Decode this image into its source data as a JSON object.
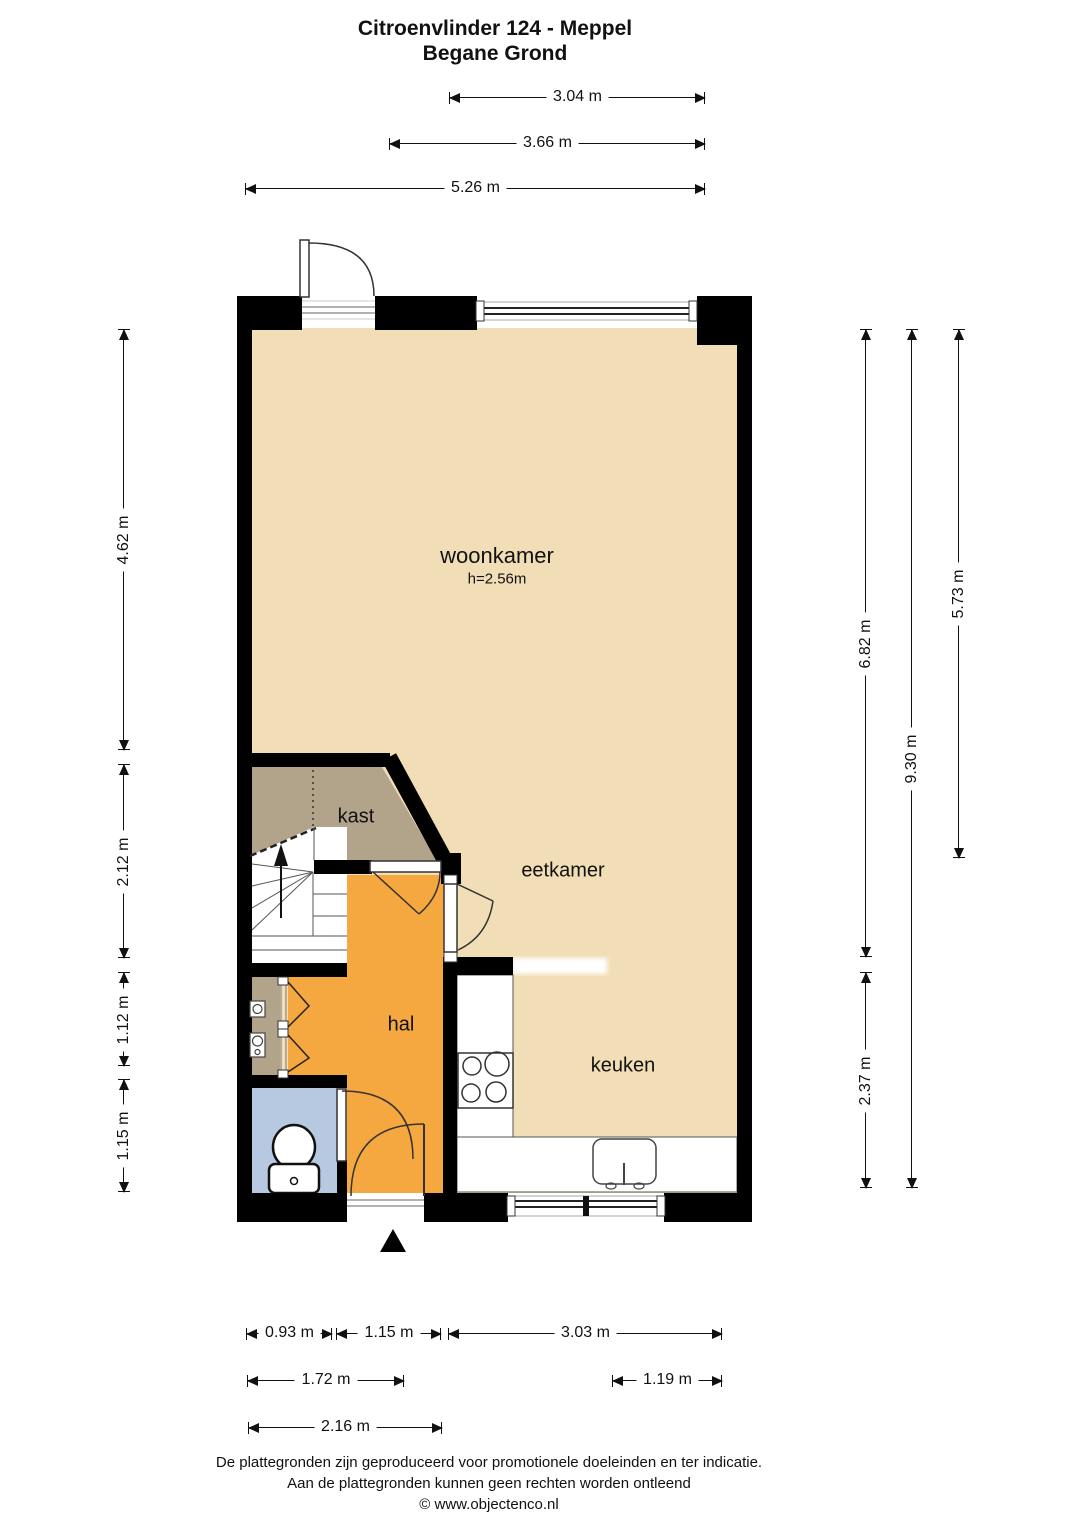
{
  "title": {
    "line1": "Citroenvlinder 124 - Meppel",
    "line2": "Begane Grond"
  },
  "rooms": {
    "woonkamer": {
      "label": "woonkamer",
      "height_note": "h=2.56m"
    },
    "kast": {
      "label": "kast"
    },
    "eetkamer": {
      "label": "eetkamer"
    },
    "hal": {
      "label": "hal"
    },
    "keuken": {
      "label": "keuken"
    }
  },
  "dimensions": {
    "top": [
      "3.04 m",
      "3.66 m",
      "5.26 m"
    ],
    "left": [
      "4.62 m",
      "2.12 m",
      "1.12 m",
      "1.15 m"
    ],
    "right": [
      "6.82 m",
      "9.30 m",
      "5.73 m",
      "2.37 m"
    ],
    "bottom": [
      "0.93 m",
      "1.15 m",
      "3.03 m",
      "1.72 m",
      "1.19 m",
      "2.16 m"
    ]
  },
  "footer": {
    "line1": "De plattegronden zijn geproduceerd voor promotionele doeleinden en ter indicatie.",
    "line2": "Aan de plattegronden kunnen geen rechten worden ontleend",
    "line3": "© www.objectenco.nl"
  },
  "colors": {
    "floor": "#f2deb6",
    "closet": "#b2a48a",
    "hall": "#f6a840",
    "toilet_room": "#b7c9e0",
    "wall": "#000000"
  }
}
